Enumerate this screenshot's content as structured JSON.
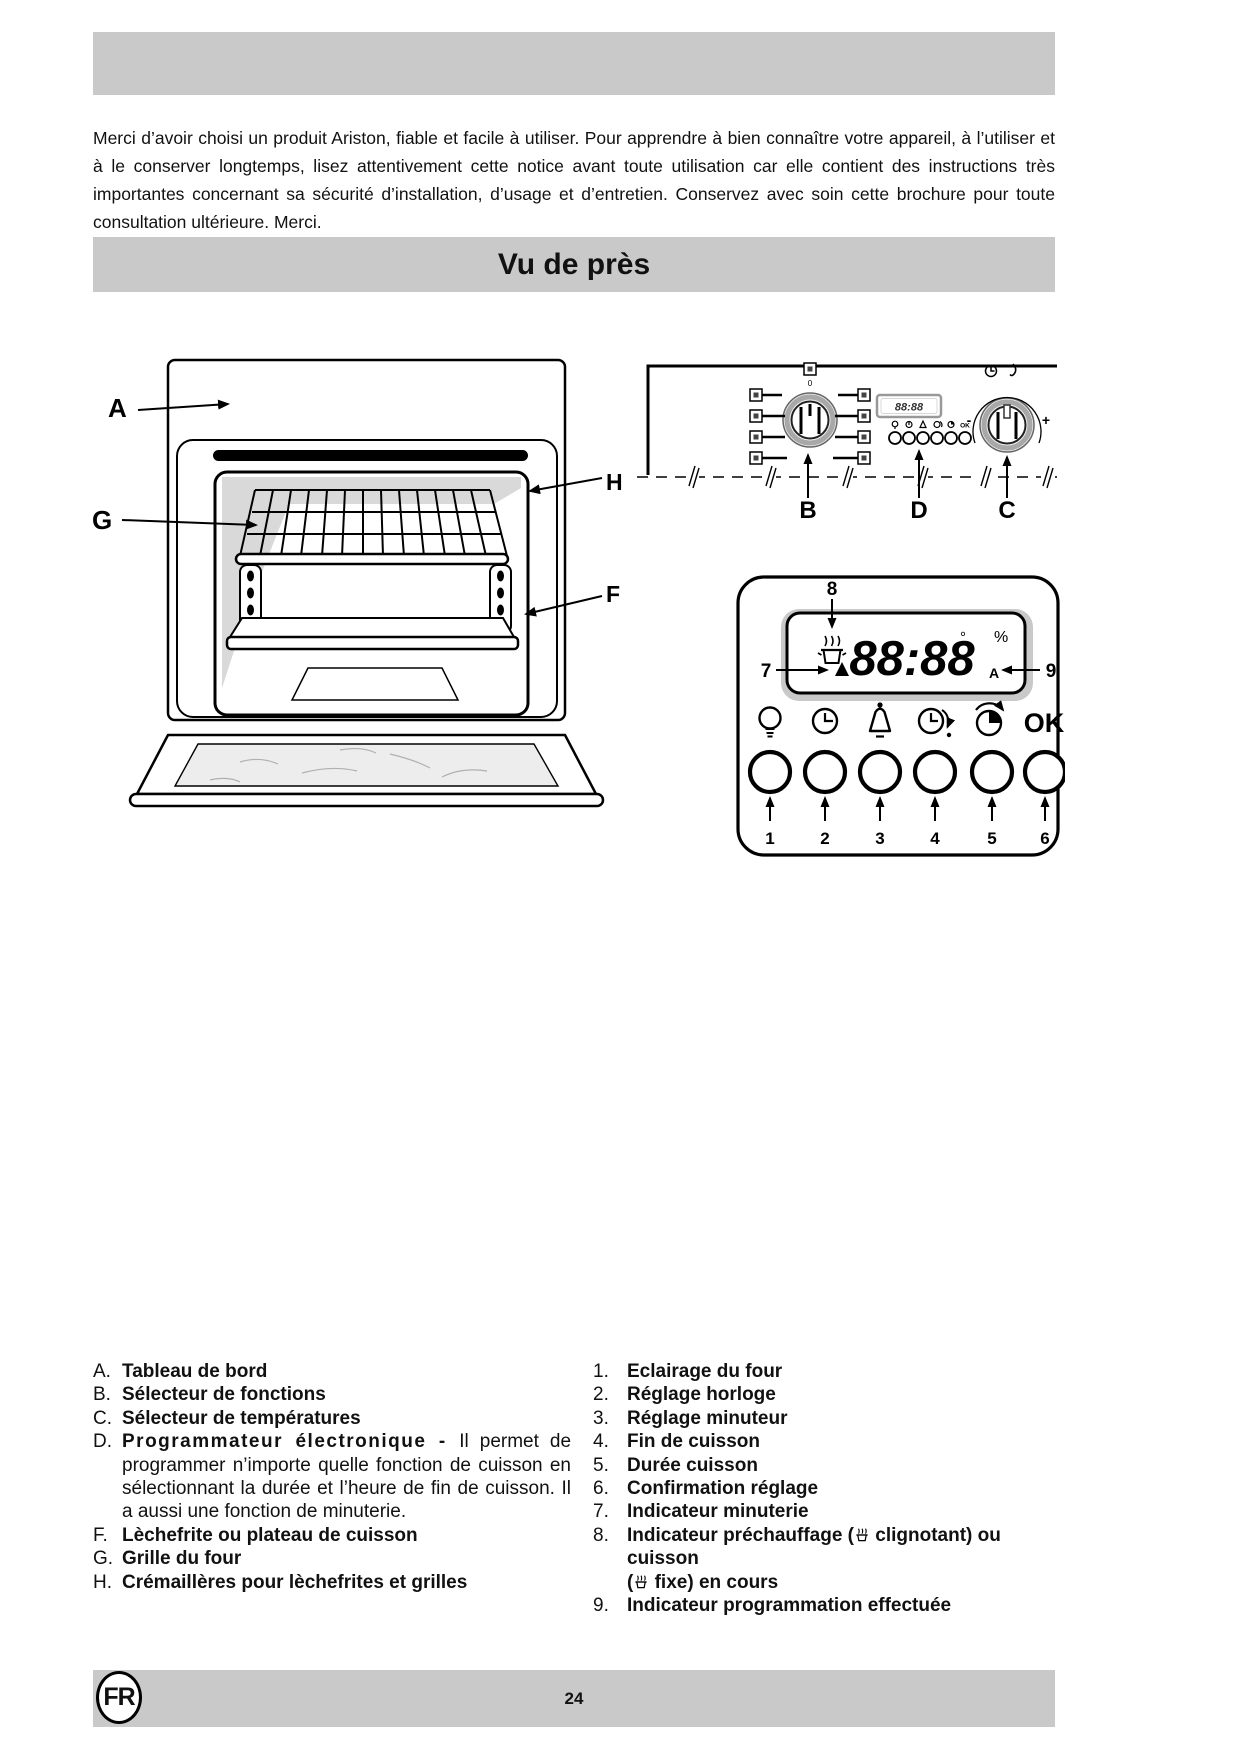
{
  "page": {
    "intro": "Merci d’avoir choisi un produit Ariston, fiable et facile à utiliser. Pour apprendre à bien connaître votre appareil, à l’utiliser et à le conserver longtemps, lisez attentivement cette notice avant toute utilisation car elle contient des instructions très importantes concernant sa sécurité d’installation, d’usage et d’entretien. Conservez avec soin cette brochure pour toute consultation ultérieure. Merci.",
    "section_title": "Vu de près",
    "page_number": "24",
    "language_badge": "FR"
  },
  "colors": {
    "band_gray": "#c9c9c9",
    "ink": "#111111"
  },
  "diagram": {
    "callout_a": "A",
    "callout_b": "B",
    "callout_c": "C",
    "callout_d": "D",
    "callout_f": "F",
    "callout_g": "G",
    "callout_h": "H",
    "knob_b_zero": "0",
    "knob_c_minus": "-",
    "knob_c_plus": "+",
    "mini_display": "88:88",
    "mini_ok": "OK",
    "programmer": {
      "display": "88:88",
      "degree": "°",
      "percent": "%",
      "auto": "A",
      "ok": "OK",
      "callout_7": "7",
      "callout_8": "8",
      "callout_9": "9",
      "buttons": [
        "1",
        "2",
        "3",
        "4",
        "5",
        "6"
      ]
    }
  },
  "legend_left": {
    "items": [
      {
        "marker": "A.",
        "label": "Tableau de bord"
      },
      {
        "marker": "B.",
        "label": "Sélecteur de fonctions"
      },
      {
        "marker": "C.",
        "label": "Sélecteur de températures"
      },
      {
        "marker": "D.",
        "bold": "Programmateur électronique - ",
        "rest": "Il permet de programmer n’importe quelle fonction de cuisson en sélectionnant la durée et l’heure de fin de cuisson. Il a aussi une fonction de minuterie."
      },
      {
        "marker": "F.",
        "label": "Lèchefrite ou plateau de cuisson"
      },
      {
        "marker": "G.",
        "label": "Grille du four"
      },
      {
        "marker": "H.",
        "label": "Crémaillères pour lèchefrites et grilles"
      }
    ]
  },
  "legend_right": {
    "items": [
      {
        "marker": "1.",
        "label": "Eclairage du four"
      },
      {
        "marker": "2.",
        "label": "Réglage horloge"
      },
      {
        "marker": "3.",
        "label": "Réglage minuteur"
      },
      {
        "marker": "4.",
        "label": "Fin de cuisson"
      },
      {
        "marker": "5.",
        "label": "Durée cuisson"
      },
      {
        "marker": "6.",
        "label": "Confirmation réglage"
      },
      {
        "marker": "7.",
        "label": "Indicateur minuterie"
      },
      {
        "marker": "8.",
        "p1": "Indicateur préchauffage (",
        "p2": " clignotant) ou cuisson",
        "p3": "(",
        "p4": " fixe) en cours"
      },
      {
        "marker": "9.",
        "label": "Indicateur programmation effectuée"
      }
    ]
  }
}
